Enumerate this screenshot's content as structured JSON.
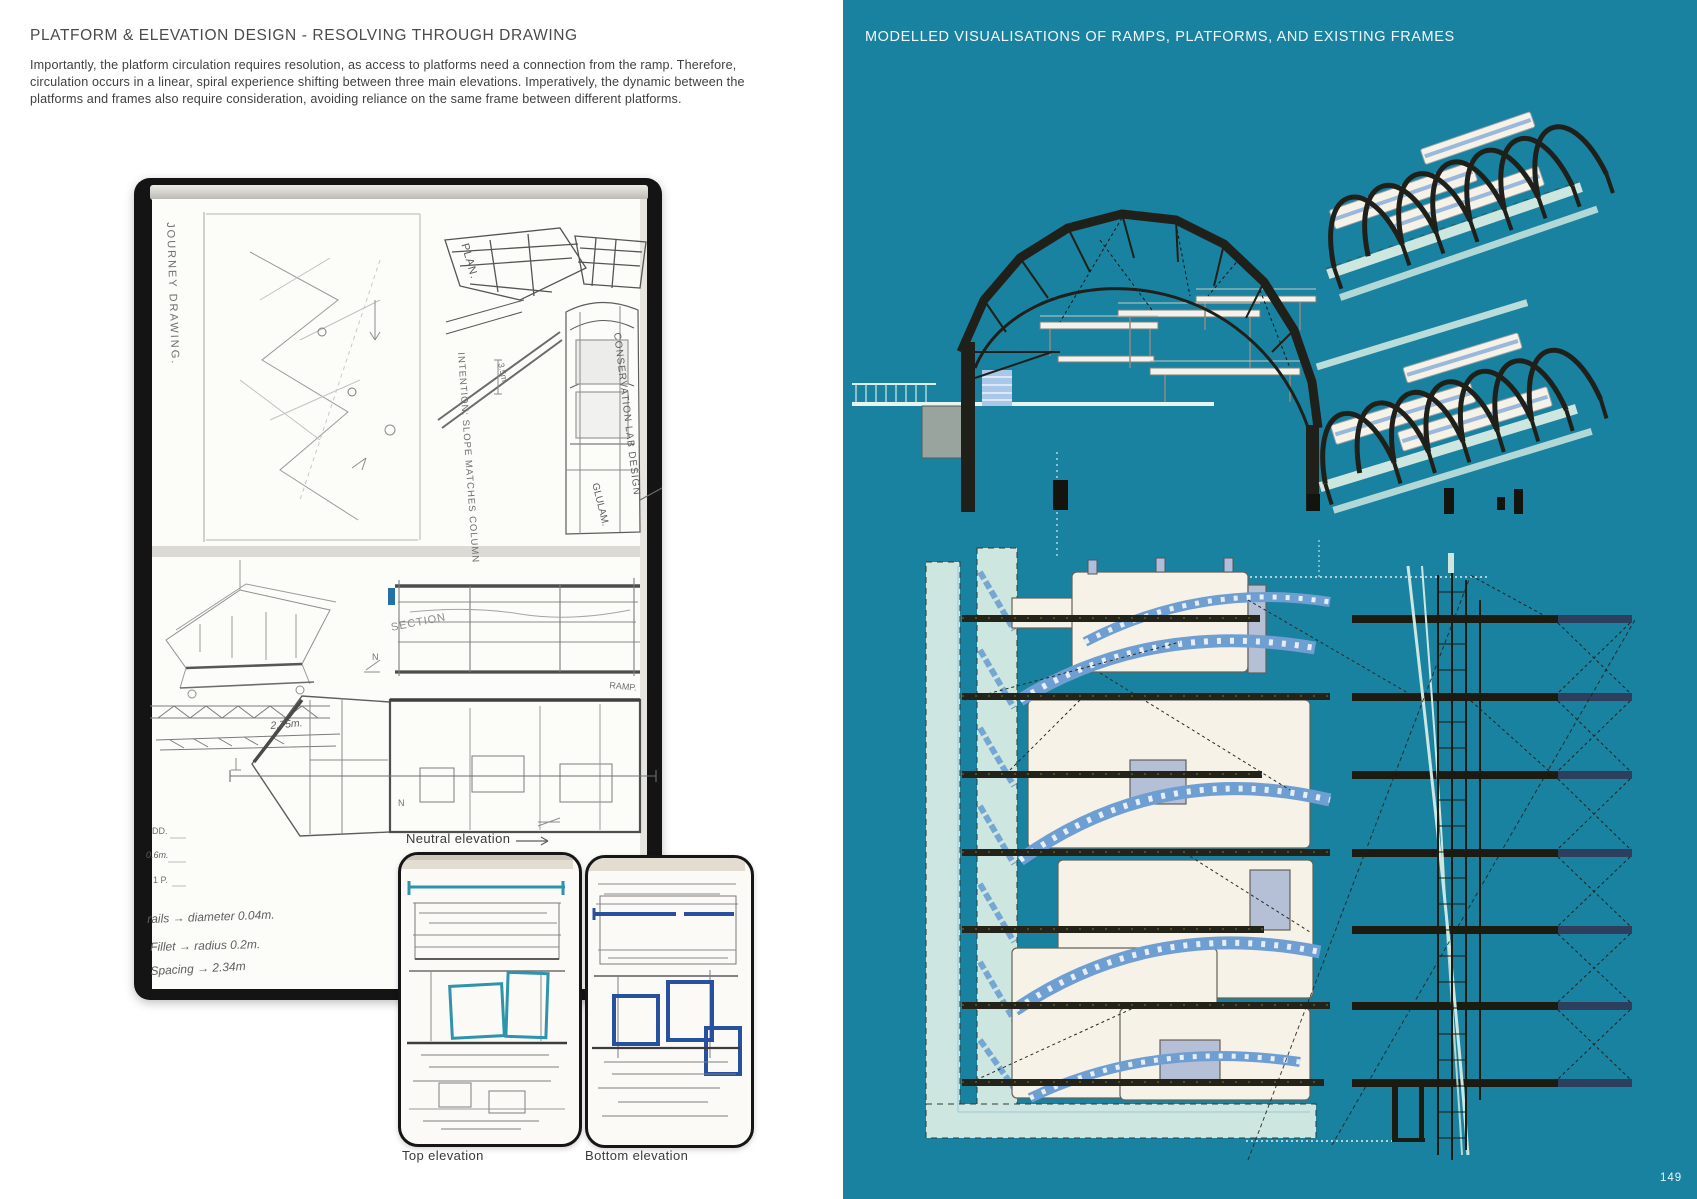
{
  "document": {
    "page_number": "149"
  },
  "left_page": {
    "title": "PLATFORM & ELEVATION DESIGN - RESOLVING THROUGH DRAWING",
    "paragraph": "Importantly, the platform circulation requires resolution, as access to platforms need a connection from the ramp. Therefore, circulation occurs in a linear, spiral experience shifting between three main elevations. Imperatively, the dynamic between the platforms and frames also require consideration, avoiding reliance on the same frame between different platforms.",
    "sketchbook": {
      "handwritten": {
        "journey": "JOURNEY DRAWING.",
        "plan": "PLAN.",
        "dim_3_5": "3.5m.",
        "intention": "INTENTION: SLOPE MATCHES COLUMN",
        "conservation": "CONSERVATION LAB DESIGN",
        "glulam": "GLULAM.",
        "section": "SECTION",
        "ramp": "RAMP.",
        "dim_2_75": "2.75m.",
        "dim_dd": "DD.",
        "dim_0_6": "0.6m.",
        "dim_1p": "1 P.",
        "re": "RE.",
        "north": "N",
        "note_rails": "rails → diameter 0.04m.",
        "note_fillet": "Fillet → radius 0.2m.",
        "note_spacing": "Spacing → 2.34m"
      },
      "labels": {
        "neutral_elevation": "Neutral elevation",
        "top_elevation": "Top elevation",
        "bottom_elevation": "Bottom elevation"
      }
    }
  },
  "right_page": {
    "title": "MODELLED VISUALISATIONS OF RAMPS, PLATFORMS, AND EXISTING FRAMES",
    "palette": {
      "background_teal": "#1982a0",
      "ramp_mint": "#cde7e0",
      "platform_cream": "#f7f2e7",
      "truss_shadow_blue": "#6f9fd2",
      "frame_dark": "#1c1c14",
      "beam_navy": "#2e3f5e"
    }
  }
}
